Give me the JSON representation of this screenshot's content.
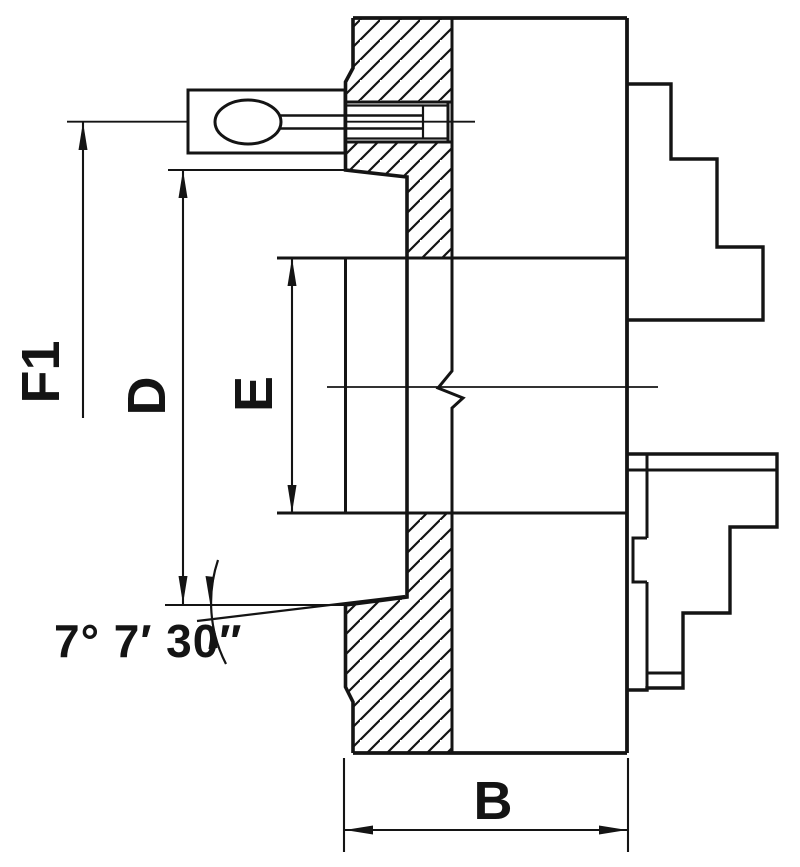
{
  "document": {
    "title": "Lathe chuck cross-section technical drawing",
    "view": "side section view with stepped jaws"
  },
  "colors": {
    "line": "#141414",
    "background": "#ffffff"
  },
  "labels": {
    "f1": "F1",
    "d": "D",
    "e": "E",
    "b": "B",
    "taper_angle": "7° 7′ 30″"
  }
}
